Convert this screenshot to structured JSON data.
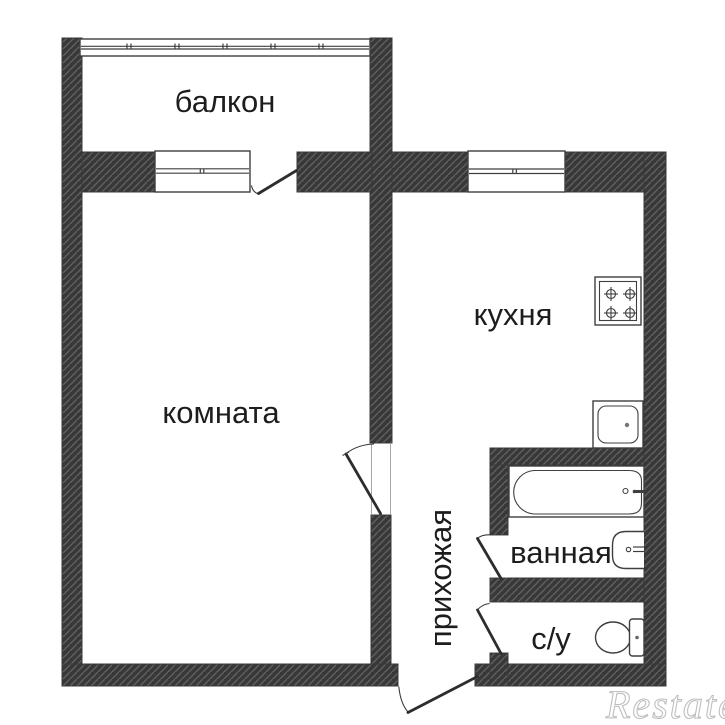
{
  "floor_plan": {
    "rooms": [
      {
        "id": "balcony",
        "label": "балкон"
      },
      {
        "id": "room",
        "label": "комната"
      },
      {
        "id": "kitchen",
        "label": "кухня"
      },
      {
        "id": "hallway",
        "label": "прихожая"
      },
      {
        "id": "bathroom",
        "label": "ванная"
      },
      {
        "id": "wc",
        "label": "с/у"
      }
    ],
    "watermark": "Restate",
    "fixtures": [
      "stove-icon",
      "kitchen-sink-icon",
      "bathtub-icon",
      "washbasin-icon",
      "toilet-icon"
    ],
    "colors": {
      "wall": "#383838",
      "hatch": "#5f5f5f",
      "line": "#3f3f3f",
      "text": "#1d1d1d",
      "watermark": "#bfbfbf",
      "background": "#ffffff"
    }
  }
}
